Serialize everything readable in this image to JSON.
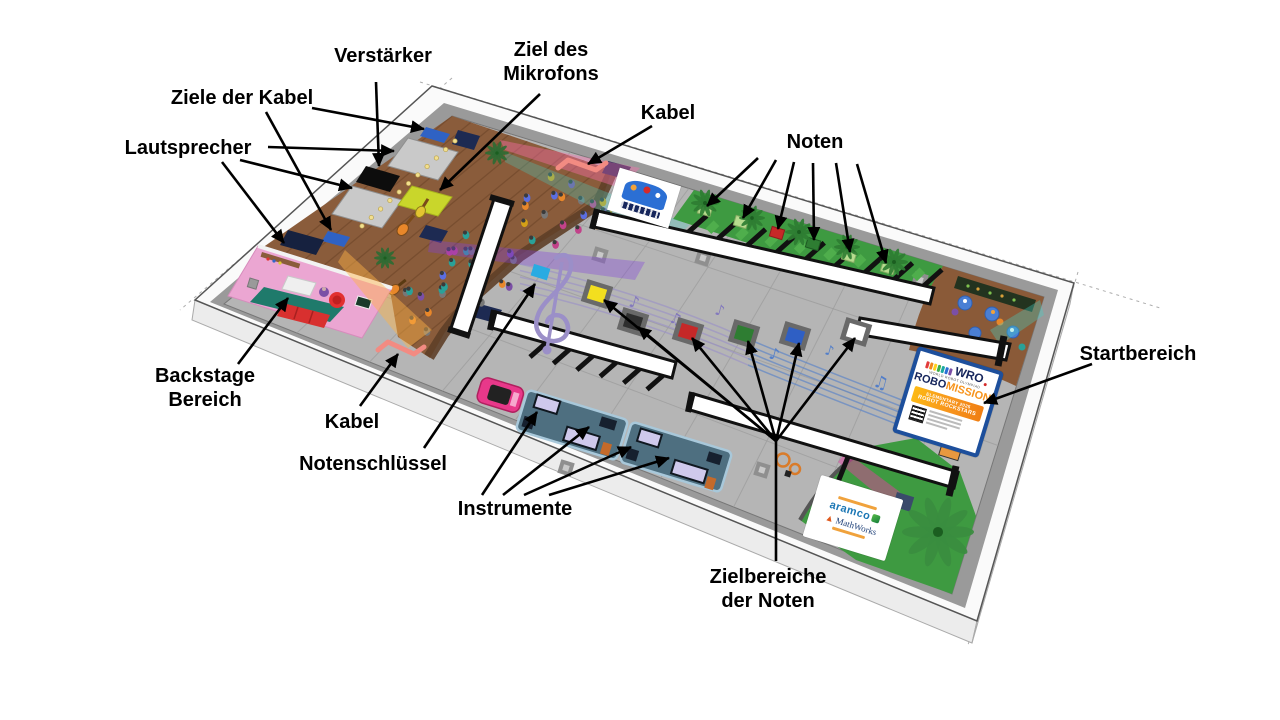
{
  "labels": {
    "amplifier": "Verstärker",
    "mic_target_1": "Ziel des",
    "mic_target_2": "Mikrofons",
    "cable_targets": "Ziele der Kabel",
    "speakers": "Lautsprecher",
    "cable_top": "Kabel",
    "notes": "Noten",
    "backstage_1": "Backstage",
    "backstage_2": "Bereich",
    "cable_bottom": "Kabel",
    "clef": "Notenschlüssel",
    "instruments": "Instrumente",
    "note_targets_1": "Zielbereiche",
    "note_targets_2": "der Noten",
    "start_area": "Startbereich"
  },
  "start_sign": {
    "wro": "WRO",
    "tagline": "WORLD ROBOT OLYMPIAD",
    "robo": "ROBO",
    "mission": "MISSION",
    "season_category": "ELEMENTARY 2025",
    "season_name": "ROBOT ROCKSTARS"
  },
  "sponsor_tile": {
    "partner1": "aramco",
    "partner2": "MathWorks"
  },
  "field": {
    "note_colors": [
      "#b7dc8f",
      "#b7dc8f",
      "#c62828",
      "#2e7d32",
      "#b7dc8f",
      "#b7dc8f"
    ],
    "target_colors": [
      "#f3df1f",
      "#2f2f2f",
      "#c62828",
      "#2e7d32",
      "#2f5fc4",
      "#ffffff"
    ],
    "colors": {
      "mat_gray": "#b5b5b5",
      "stage_wood": "#8a5c3b",
      "backstage_pink": "#eba6d2",
      "grass_green": "#3e9a41",
      "start_border_blue": "#1d4f9c",
      "mission_orange": "#f7941d",
      "clef_purple": "#9b8fc8",
      "staff_blue": "#527ec9",
      "cable_pink": "#f28b82",
      "mic_target_yellow": "#c9d62b",
      "clef_marker_cyan": "#29abe2"
    }
  }
}
